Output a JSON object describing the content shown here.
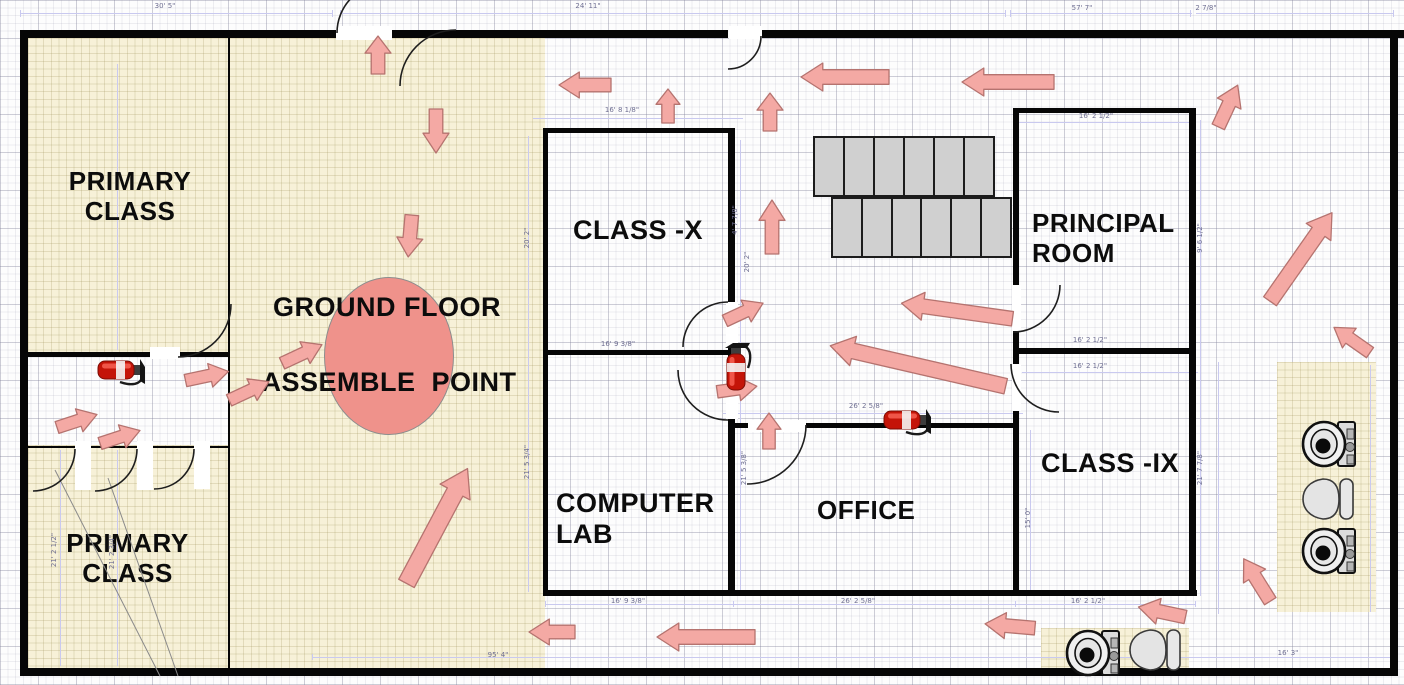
{
  "plan": {
    "room_labels": {
      "primary_top": "PRIMARY CLASS",
      "primary_bottom": "PRIMARY CLASS",
      "class_x": "CLASS -X",
      "computer_lab": "COMPUTER LAB",
      "office": "OFFICE",
      "principal": "PRINCIPAL ROOM",
      "class_ix": "CLASS -IX",
      "ground_floor": "GROUND FLOOR",
      "assemble_point": "ASSEMBLE  POINT"
    },
    "colors": {
      "room_fill": "#f7f1d8",
      "arrow_fill": "#f4a9a4",
      "arrow_stroke": "#b5736f",
      "assemble_fill": "#ef928b",
      "assemble_stroke": "#8c8c8c",
      "stairs_fill": "#d0d0d0",
      "wall": "#060606",
      "dim_text": "#6f6f92",
      "extinguisher_red": "#c41408"
    },
    "dimensions": [
      {
        "text": "30' 5\"",
        "x": 165,
        "y": 6,
        "rot": 0
      },
      {
        "text": "24' 11\"",
        "x": 588,
        "y": 6,
        "rot": 0
      },
      {
        "text": "57' 7\"",
        "x": 1082,
        "y": 8,
        "rot": 0
      },
      {
        "text": "2 7/8\"",
        "x": 1206,
        "y": 8,
        "rot": 0
      },
      {
        "text": "16' 8 1/8\"",
        "x": 622,
        "y": 110,
        "rot": 0
      },
      {
        "text": "16' 2 1/2\"",
        "x": 1096,
        "y": 116,
        "rot": 0
      },
      {
        "text": "16' 9 3/8\"",
        "x": 618,
        "y": 344,
        "rot": 0
      },
      {
        "text": "16' 2 1/2\"",
        "x": 1090,
        "y": 340,
        "rot": 0
      },
      {
        "text": "16' 2 1/2\"",
        "x": 1090,
        "y": 366,
        "rot": 0
      },
      {
        "text": "26' 2 5/8\"",
        "x": 866,
        "y": 406,
        "rot": 0
      },
      {
        "text": "16' 9 3/8\"",
        "x": 628,
        "y": 601,
        "rot": 0
      },
      {
        "text": "26' 2 5/8\"",
        "x": 858,
        "y": 601,
        "rot": 0
      },
      {
        "text": "16' 2 1/2\"",
        "x": 1088,
        "y": 601,
        "rot": 0
      },
      {
        "text": "95' 4\"",
        "x": 498,
        "y": 655,
        "rot": 0
      },
      {
        "text": "16' 3\"",
        "x": 1288,
        "y": 653,
        "rot": 0
      },
      {
        "text": "20' 2\"",
        "x": 527,
        "y": 238,
        "rot": -90
      },
      {
        "text": "21' 5 3/4\"",
        "x": 527,
        "y": 462,
        "rot": -90
      },
      {
        "text": "4' 7 7/8\"",
        "x": 735,
        "y": 220,
        "rot": -90
      },
      {
        "text": "20' 2\"",
        "x": 747,
        "y": 262,
        "rot": -90
      },
      {
        "text": "21' 5 3/8\"",
        "x": 744,
        "y": 468,
        "rot": -90
      },
      {
        "text": "21' 2 1/2\"",
        "x": 54,
        "y": 550,
        "rot": -90
      },
      {
        "text": "21' 2 3/4\"",
        "x": 112,
        "y": 552,
        "rot": -90
      },
      {
        "text": "9' 6 1/2\"",
        "x": 1200,
        "y": 238,
        "rot": -90
      },
      {
        "text": "21' 7 7/8\"",
        "x": 1200,
        "y": 468,
        "rot": -90
      },
      {
        "text": "15' 0\"",
        "x": 1028,
        "y": 518,
        "rot": -90
      }
    ],
    "arrows": [
      [
        585,
        85,
        52,
        26,
        180
      ],
      [
        668,
        106,
        34,
        24,
        -90
      ],
      [
        770,
        112,
        38,
        26,
        -90
      ],
      [
        845,
        77,
        88,
        28,
        180
      ],
      [
        1008,
        82,
        92,
        28,
        180
      ],
      [
        1228,
        106,
        46,
        26,
        -65
      ],
      [
        378,
        55,
        38,
        26,
        -90
      ],
      [
        436,
        131,
        44,
        26,
        90
      ],
      [
        410,
        236,
        42,
        26,
        95
      ],
      [
        772,
        227,
        54,
        26,
        -90
      ],
      [
        744,
        312,
        42,
        24,
        -25
      ],
      [
        737,
        389,
        40,
        24,
        -8
      ],
      [
        769,
        431,
        36,
        24,
        -90
      ],
      [
        957,
        311,
        112,
        28,
        188
      ],
      [
        918,
        366,
        180,
        30,
        193
      ],
      [
        207,
        376,
        44,
        24,
        -12
      ],
      [
        77,
        421,
        42,
        24,
        -18
      ],
      [
        120,
        437,
        42,
        24,
        -18
      ],
      [
        249,
        391,
        44,
        24,
        -25
      ],
      [
        302,
        354,
        44,
        24,
        -25
      ],
      [
        437,
        526,
        130,
        34,
        -62
      ],
      [
        552,
        632,
        46,
        26,
        180
      ],
      [
        706,
        637,
        98,
        28,
        180
      ],
      [
        1010,
        626,
        50,
        26,
        185
      ],
      [
        1162,
        612,
        48,
        26,
        192
      ],
      [
        1257,
        580,
        50,
        26,
        238
      ],
      [
        1301,
        257,
        108,
        30,
        -55
      ],
      [
        1352,
        340,
        44,
        24,
        215
      ]
    ],
    "stairs": {
      "rows": [
        {
          "x": 813,
          "y": 136,
          "w": 182,
          "h": 61,
          "cells": 6
        },
        {
          "x": 831,
          "y": 197,
          "w": 181,
          "h": 61,
          "cells": 6
        }
      ]
    },
    "fixtures": {
      "extinguishers": [
        {
          "x": 736,
          "y": 366,
          "rot": 0
        },
        {
          "x": 122,
          "y": 370,
          "rot": 90
        },
        {
          "x": 908,
          "y": 420,
          "rot": 90
        }
      ],
      "toilets": [
        {
          "x": 1330,
          "y": 444
        },
        {
          "x": 1330,
          "y": 551
        },
        {
          "x": 1094,
          "y": 653
        }
      ],
      "basins": [
        {
          "x": 1329,
          "y": 499
        },
        {
          "x": 1156,
          "y": 650
        }
      ]
    },
    "geometry": {
      "beige_regions": [
        [
          228,
          38,
          317,
          630
        ],
        [
          28,
          38,
          200,
          316
        ],
        [
          28,
          445,
          200,
          223
        ],
        [
          1277,
          362,
          99,
          250
        ],
        [
          1041,
          628,
          148,
          44
        ]
      ],
      "ellipse": [
        324,
        277,
        128,
        156
      ],
      "walls": [
        [
          20,
          30,
          316,
          8
        ],
        [
          392,
          30,
          336,
          8
        ],
        [
          762,
          30,
          642,
          8
        ],
        [
          20,
          30,
          8,
          646
        ],
        [
          20,
          668,
          1378,
          8
        ],
        [
          1390,
          30,
          8,
          646
        ],
        [
          543,
          128,
          192,
          5
        ],
        [
          543,
          128,
          5,
          227
        ],
        [
          543,
          350,
          5,
          242
        ],
        [
          543,
          350,
          190,
          5
        ],
        [
          543,
          590,
          654,
          6
        ],
        [
          728,
          128,
          7,
          176
        ],
        [
          728,
          346,
          7,
          26
        ],
        [
          728,
          418,
          7,
          174
        ],
        [
          735,
          423,
          13,
          5
        ],
        [
          806,
          423,
          209,
          5
        ],
        [
          1013,
          108,
          182,
          5
        ],
        [
          1013,
          108,
          6,
          179
        ],
        [
          1013,
          330,
          6,
          36
        ],
        [
          1013,
          410,
          6,
          182
        ],
        [
          1189,
          108,
          7,
          488
        ],
        [
          1013,
          348,
          182,
          6
        ],
        [
          228,
          36,
          2,
          633
        ],
        [
          27,
          352,
          123,
          5
        ],
        [
          180,
          352,
          50,
          5
        ],
        [
          28,
          446,
          200,
          2
        ]
      ],
      "door_leaves": [
        [
          336,
          26,
          56,
          14
        ],
        [
          729,
          26,
          33,
          13
        ],
        [
          150,
          347,
          30,
          12
        ],
        [
          75,
          441,
          16,
          49
        ],
        [
          137,
          441,
          16,
          49
        ],
        [
          194,
          441,
          16,
          48
        ],
        [
          748,
          420,
          58,
          12
        ],
        [
          1012,
          285,
          9,
          46
        ],
        [
          1012,
          364,
          9,
          47
        ],
        [
          726,
          302,
          12,
          45
        ],
        [
          726,
          370,
          12,
          49
        ]
      ],
      "door_arcs": [
        "M 337,33 A 50,50 0 0 1 387,-17",
        "M 400,86 A 56,56 0 0 1 456,30",
        "M 761,36 A 33,33 0 0 1 728,69",
        "M 178,357 A 53,53 0 0 0 231,304",
        "M 75,449 A 42,42 0 0 1 33,491",
        "M 137,449 A 42,42 0 0 1 95,491",
        "M 194,449 A 40,40 0 0 1 154,489",
        "M 728,302 A 45,45 0 0 0 683,347",
        "M 678,370 A 50,50 0 0 0 728,420",
        "M 806,425 A 59,59 0 0 1 747,484",
        "M 1060,285 A 47,47 0 0 1 1013,332",
        "M 1011,364 A 48,48 0 0 0 1059,412"
      ],
      "leader_lines": [
        "M 55,470 L 160,676",
        "M 108,478 L 178,676"
      ],
      "guides": [
        [
          20,
          13,
          312,
          1
        ],
        [
          340,
          13,
          665,
          1
        ],
        [
          1010,
          13,
          182,
          1
        ],
        [
          1196,
          13,
          198,
          1
        ],
        [
          20,
          10,
          1,
          7
        ],
        [
          332,
          10,
          1,
          7
        ],
        [
          340,
          10,
          1,
          7
        ],
        [
          1005,
          10,
          1,
          7
        ],
        [
          1010,
          10,
          1,
          7
        ],
        [
          1190,
          10,
          1,
          7
        ],
        [
          1393,
          10,
          1,
          7
        ],
        [
          312,
          657,
          1086,
          1
        ],
        [
          312,
          654,
          1,
          6
        ],
        [
          1397,
          654,
          1,
          6
        ],
        [
          545,
          604,
          650,
          1
        ],
        [
          545,
          601,
          1,
          6
        ],
        [
          733,
          601,
          1,
          6
        ],
        [
          1015,
          601,
          1,
          6
        ],
        [
          1195,
          601,
          1,
          6
        ],
        [
          528,
          136,
          1,
          456
        ],
        [
          740,
          140,
          1,
          452
        ],
        [
          1200,
          120,
          1,
          476
        ],
        [
          1218,
          362,
          1,
          252
        ],
        [
          60,
          450,
          1,
          216
        ],
        [
          117,
          450,
          1,
          216
        ],
        [
          117,
          64,
          1,
          286
        ],
        [
          1370,
          365,
          1,
          247
        ],
        [
          1030,
          430,
          1,
          162
        ],
        [
          533,
          118,
          210,
          1
        ],
        [
          1018,
          122,
          176,
          1
        ],
        [
          1022,
          372,
          176,
          1
        ],
        [
          723,
          413,
          300,
          1
        ]
      ]
    }
  }
}
